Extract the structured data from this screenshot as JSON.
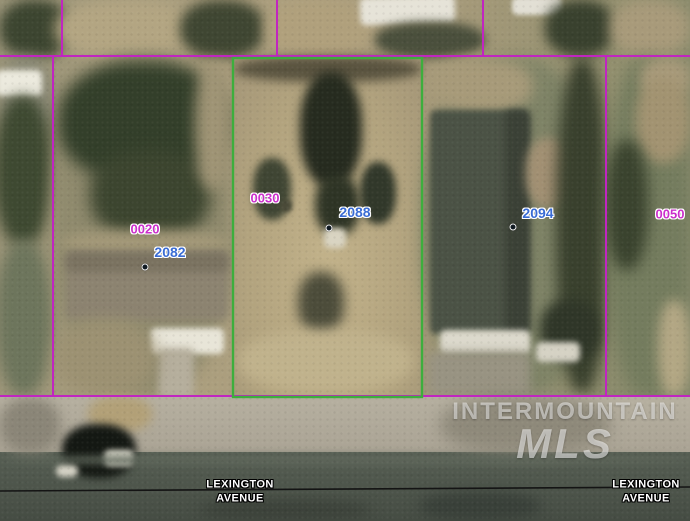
{
  "parcel_labels": {
    "p0020": "0020",
    "p0030": "0030",
    "p0050": "0050"
  },
  "address_labels": {
    "a2082": "2082",
    "a2088": "2088",
    "a2094": "2094"
  },
  "street_left": {
    "line1": "LEXINGTON",
    "line2": "AVENUE"
  },
  "street_right": {
    "line1": "LEXINGTON",
    "line2": "AVENUE"
  },
  "watermark": {
    "line1": "INTERMOUNTAIN",
    "line2": "MLS"
  },
  "colors": {
    "parcel_boundary_line": "#c125c1",
    "highlighted_parcel_outline": "#3dae3d",
    "parcel_number_text": "#cb2ecb",
    "address_number_text": "#3a6cd4",
    "street_centerline": "#141414",
    "street_label_text": "#ffffff",
    "watermark_text": "rgba(255,255,255,0.55)"
  }
}
